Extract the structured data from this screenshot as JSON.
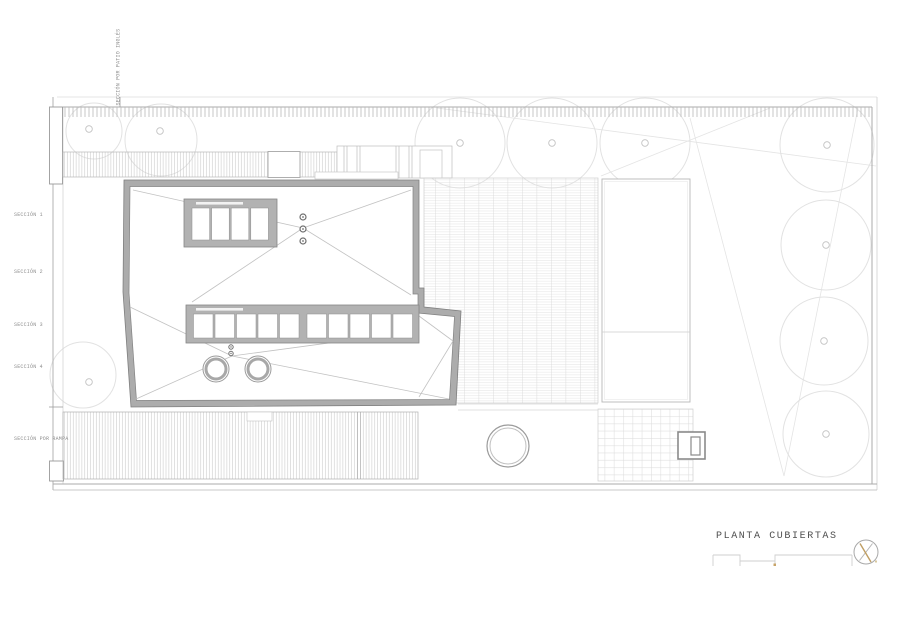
{
  "drawing": {
    "title": "PLANTA CUBIERTAS",
    "vertical_section_label": "SECCIÓN POR PATIO INGLÉS",
    "section_labels": [
      "SECCIÓN 1",
      "SECCIÓN 2",
      "SECCIÓN 3",
      "SECCIÓN 4",
      "SECCIÓN POR RAMPA"
    ],
    "icons": {
      "north_arrow": "compass-north-icon",
      "scale_bar": "graphic-scale-bar"
    },
    "colors": {
      "paper": "#ffffff",
      "roof_border_fill": "#acacac",
      "roof_edge_line": "#7f7f7f",
      "hatch_line": "#c6c6c6",
      "boundary_line": "#a3a3a3",
      "tree_line": "#e2e2e2",
      "accent_tan": "#c8a468",
      "label_text": "#8f8f8f",
      "title_text": "#4f4f4f"
    }
  }
}
